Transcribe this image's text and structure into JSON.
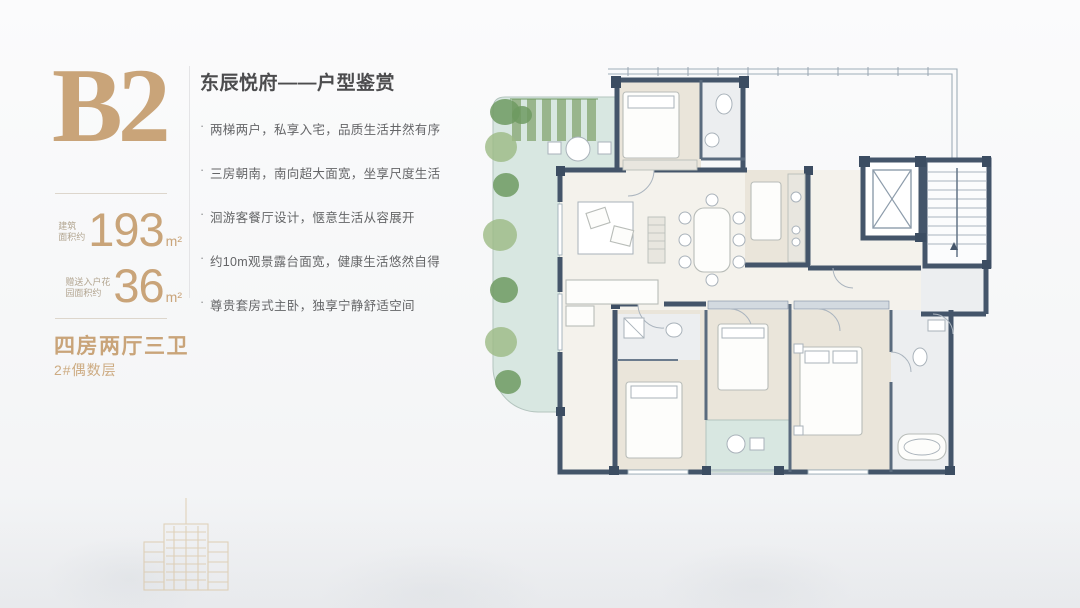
{
  "left_panel": {
    "unit_code": "B2",
    "areas": [
      {
        "label_line1": "建筑",
        "label_line2": "面积约",
        "value": "193",
        "unit": "m²"
      },
      {
        "label_line1": "赠送入户花",
        "label_line2": "园面积约",
        "value": "36",
        "unit": "m²"
      }
    ],
    "layout_type": "四房两厅三卫",
    "floor_note": "2#偶数层"
  },
  "content": {
    "title": "东辰悦府——户型鉴赏",
    "bullets": [
      "两梯两户，私享入宅，品质生活井然有序",
      "三房朝南，南向超大面宽，坐享尺度生活",
      "洄游客餐厅设计，惬意生活从容展开",
      "约10m观景露台面宽，健康生活悠然自得",
      "尊贵套房式主卧，独享宁静舒适空间"
    ]
  },
  "floor_plan": {
    "colors": {
      "accent_gold": "#c9a479",
      "wall": "#44556a",
      "terrace": "#d8e7e1",
      "room": "#eae5da",
      "living": "#f4f2ec",
      "bath": "#eceef0",
      "plant_dark": "#6f9a62",
      "plant_light": "#9cba84"
    }
  }
}
